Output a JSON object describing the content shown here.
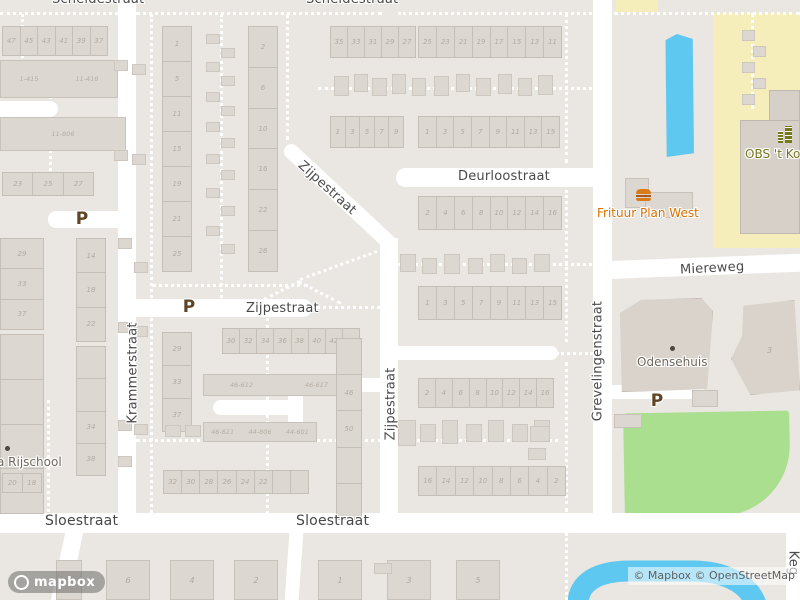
{
  "streets": {
    "scheldestraat": "Scheldestraat",
    "deurloostraat": "Deurloostraat",
    "miereweg": "Miereweg",
    "zijpestraat": "Zijpestraat",
    "krammerstraat": "Krammerstraat",
    "grevelingenstraat": "Grevelingenstraat",
    "sloestraat": "Sloestraat",
    "keg_partial": "Keg"
  },
  "pois": {
    "frituur": "Frituur Plan West",
    "school": "OBS 't Kofs",
    "odensehuis": "Odensehuis",
    "rijschool": "a Rijschool"
  },
  "parking_label": "P",
  "rows": {
    "tl_top": [
      "47",
      "45",
      "43",
      "41",
      "39",
      "37"
    ],
    "tl_row23": [
      "23",
      "25",
      "27"
    ],
    "tl_col_odd": [
      "29",
      "33",
      "37"
    ],
    "tl_col_lower": [
      "",
      "",
      "",
      ""
    ],
    "tl_col_mid": [
      "14",
      "18",
      "22"
    ],
    "tl_col_mid2": [
      "",
      "",
      "34",
      "38"
    ],
    "tl_pair": [
      "20",
      "18"
    ],
    "blockA_col_w": [
      "1",
      "5",
      "11",
      "15",
      "19",
      "21",
      "25"
    ],
    "blockA_col_e": [
      "2",
      "6",
      "10",
      "16",
      "22",
      "26"
    ],
    "blockA_col_s": [
      "29",
      "33",
      "37"
    ],
    "zijpe_row": [
      "30",
      "32",
      "34",
      "36",
      "38",
      "40",
      "42",
      "44"
    ],
    "sheds_row": [
      "32",
      "30",
      "28",
      "26",
      "24",
      "22",
      "",
      ""
    ],
    "col_46_50": [
      "",
      "46",
      "50",
      "",
      ""
    ],
    "top_r1a": [
      "35",
      "33",
      "31",
      "29",
      "27"
    ],
    "top_r1b": [
      "25",
      "23",
      "21",
      "19",
      "17",
      "15",
      "13",
      "11"
    ],
    "top_r2a": [
      "1",
      "3",
      "5",
      "7",
      "9"
    ],
    "top_r2b": [
      "1",
      "3",
      "5",
      "7",
      "9",
      "11",
      "13",
      "15"
    ],
    "deur_evens": [
      "2",
      "4",
      "6",
      "8",
      "10",
      "12",
      "14",
      "16"
    ],
    "deur_odds": [
      "1",
      "3",
      "5",
      "7",
      "9",
      "11",
      "13",
      "15"
    ],
    "south_evens": [
      "2",
      "4",
      "6",
      "8",
      "10",
      "12",
      "14",
      "16"
    ],
    "south_rev": [
      "16",
      "14",
      "12",
      "10",
      "8",
      "6",
      "4",
      "2"
    ],
    "sloe_left": [
      "6",
      "4",
      "2"
    ],
    "sloe_right": [
      "1",
      "3",
      "5"
    ]
  },
  "building_labels": {
    "rangeA1": "1-415",
    "rangeA2": "11-416",
    "rangeB": "11-806",
    "apt1": "46-612",
    "apt2": "46-617",
    "apt3": "46-611",
    "apt4": "44-806",
    "apt5": "44-601",
    "num3": "3"
  },
  "footer": {
    "attribution": "© Mapbox © OpenStreetMap",
    "logo": "mapbox"
  },
  "colors": {
    "background": "#eae6e1",
    "street": "#ffffff",
    "building": "#dcd7d0",
    "water": "#5fc8f0",
    "park_green": "#a9df8e",
    "school_yellow": "#f5edba",
    "street_label": "#4a4a4a",
    "house_number": "#b2aba2",
    "parking_brown": "#5e4526",
    "poi_orange": "#d96f00",
    "poi_olive": "#75751f",
    "poi_grey": "#6e675d"
  }
}
